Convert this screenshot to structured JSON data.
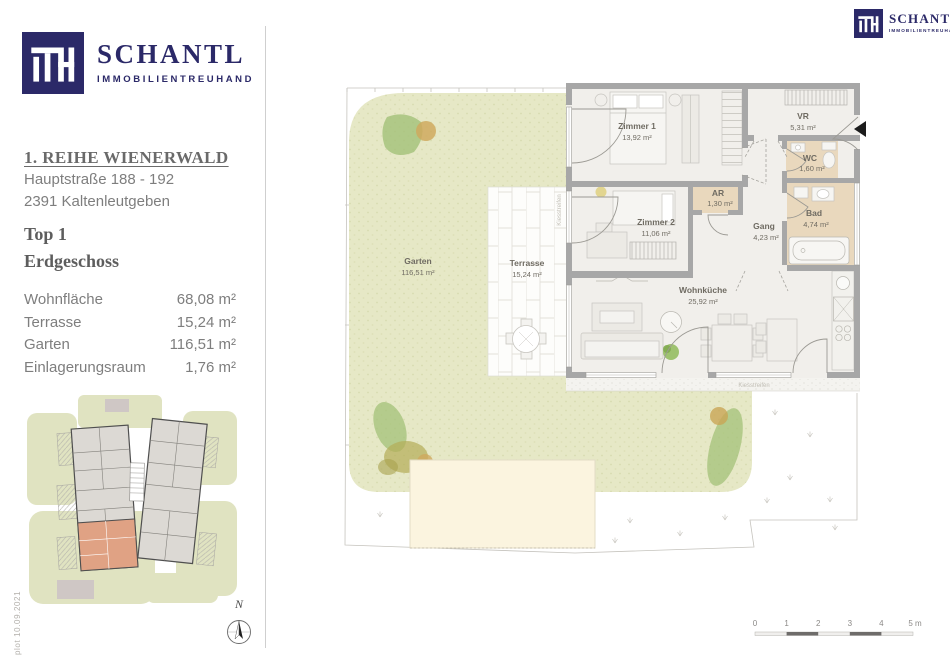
{
  "brand": {
    "monogram": "ITH",
    "name": "SCHANTL",
    "tagline": "IMMOBILIENTREUHAND",
    "navy": "#2b2968"
  },
  "sidebar": {
    "project_title": "1. REIHE WIENERWALD",
    "address_line1": "Hauptstraße 188 - 192",
    "address_line2": "2391 Kaltenleutgeben",
    "unit": "Top 1",
    "floor": "Erdgeschoss",
    "areas": [
      {
        "label": "Wohnfläche",
        "value": "68,08 m²"
      },
      {
        "label": "Terrasse",
        "value": "15,24 m²"
      },
      {
        "label": "Garten",
        "value": "116,51 m²"
      },
      {
        "label": "Einlagerungsraum",
        "value": "1,76 m²"
      }
    ]
  },
  "floorplan": {
    "rooms": {
      "zimmer1": {
        "name": "Zimmer 1",
        "area": "13,92 m²"
      },
      "vr": {
        "name": "VR",
        "area": "5,31 m²"
      },
      "wc": {
        "name": "WC",
        "area": "1,60 m²"
      },
      "ar": {
        "name": "AR",
        "area": "1,30 m²"
      },
      "zimmer2": {
        "name": "Zimmer 2",
        "area": "11,06 m²"
      },
      "gang": {
        "name": "Gang",
        "area": "4,23 m²"
      },
      "bad": {
        "name": "Bad",
        "area": "4,74 m²"
      },
      "wohnkueche": {
        "name": "Wohnküche",
        "area": "25,92 m²"
      },
      "terrasse": {
        "name": "Terrasse",
        "area": "15,24 m²"
      },
      "garten": {
        "name": "Garten",
        "area": "116,51 m²"
      }
    },
    "gravel_label": "Kiesstreifen",
    "north_label": "N"
  },
  "scalebar": {
    "ticks": [
      "0",
      "1",
      "2",
      "3",
      "4"
    ],
    "unit_label": "5 m"
  },
  "footer": {
    "plot_note": "plot  10.09.2021"
  },
  "colors": {
    "navy": "#2b2968",
    "garden_green": "#e6e8c6",
    "room_tan": "#e9d8bd",
    "wall_gray": "#a7a7a7",
    "unit_highlight": "#e0a284"
  }
}
